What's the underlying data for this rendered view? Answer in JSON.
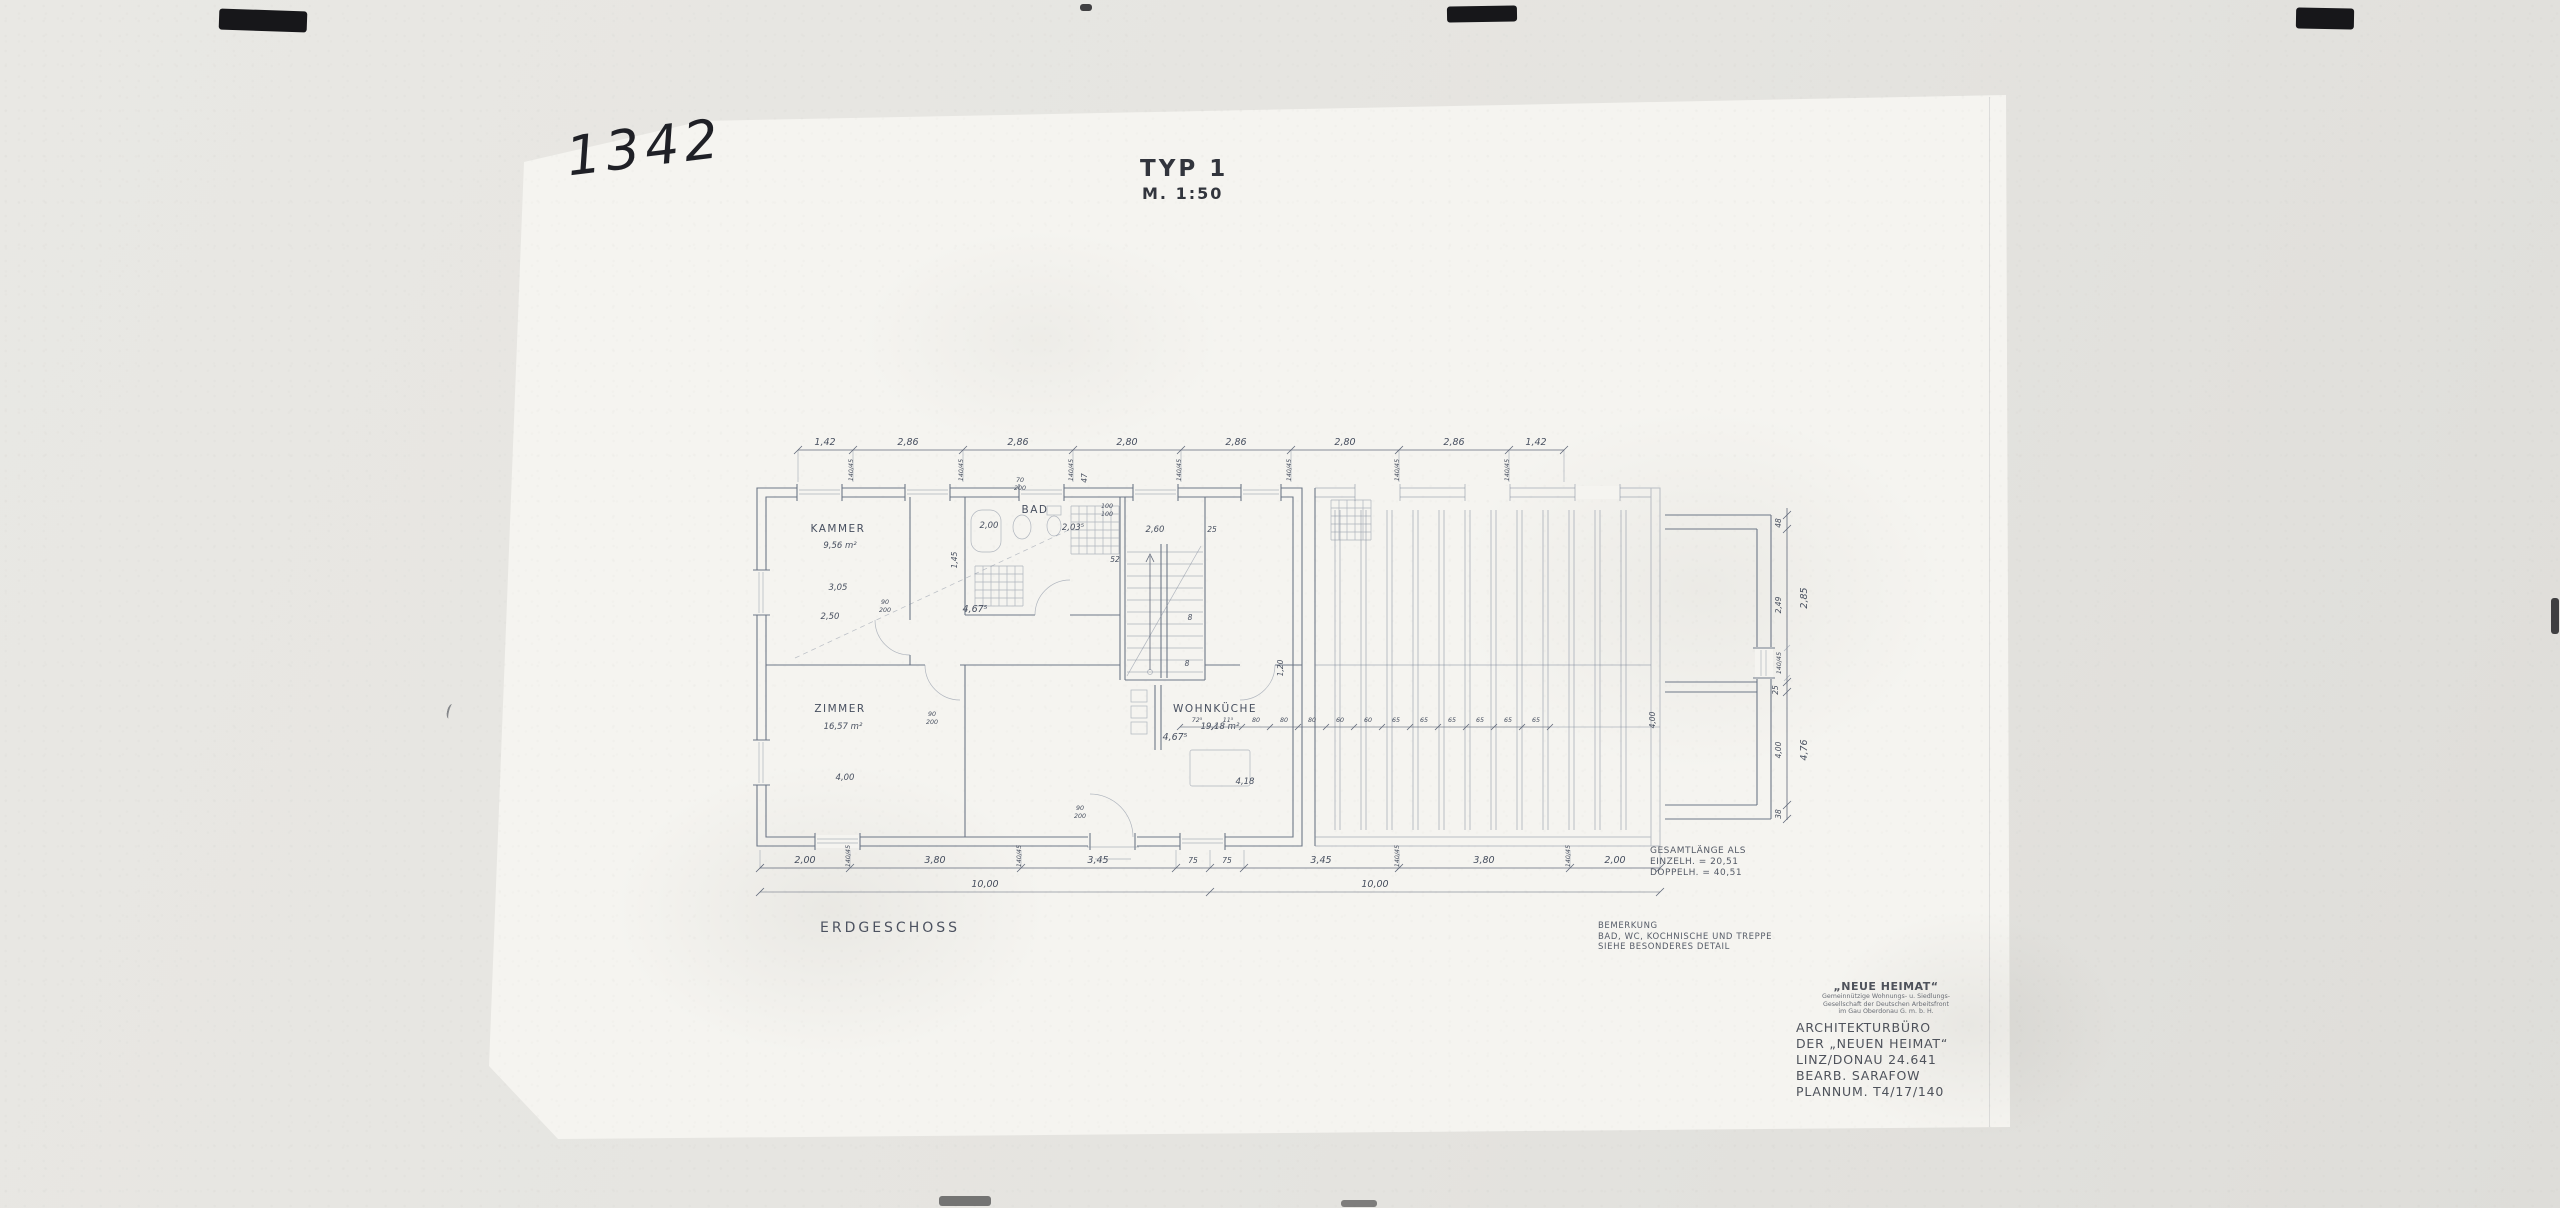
{
  "scan": {
    "handwritten_number": "1342"
  },
  "header": {
    "title": "TYP 1",
    "scale": "M. 1:50"
  },
  "plan": {
    "floor_label": "ERDGESCHOSS",
    "note": {
      "line1": "BEMERKUNG",
      "line2": "BAD, WC, KOCHNISCHE UND TREPPE",
      "line3": "SIEHE BESONDERES DETAIL"
    },
    "total_length": {
      "line1": "GESAMTLÄNGE ALS",
      "line2": "EINZELH. = 20,51",
      "line3": "DOPPELH. = 40,51"
    },
    "rooms": {
      "kammer": {
        "name": "KAMMER",
        "area": "9,56 m²"
      },
      "zimmer": {
        "name": "ZIMMER",
        "area": "16,57 m²"
      },
      "wohnkueche": {
        "name": "WOHNKÜCHE",
        "area": "19,18 m²"
      },
      "bad": {
        "name": "BAD"
      }
    },
    "dims_top": [
      "1,42",
      "2,86",
      "2,86",
      "2,80",
      "2,86",
      "2,80",
      "2,86",
      "1,42"
    ],
    "dims_bottom": [
      "2,00",
      "3,80",
      "3,45",
      "75",
      "75",
      "3,45",
      "3,80",
      "2,00"
    ],
    "totals_bottom": [
      "10,00",
      "10,00"
    ],
    "dims_right": [
      "48",
      "2,49",
      "25",
      "4,00",
      "38"
    ],
    "right_totals": [
      "2,85",
      "4,76"
    ],
    "dims_mid": [
      "72⁵",
      "11⁵",
      "80",
      "80",
      "80",
      "60",
      "60",
      "65",
      "65",
      "65",
      "65",
      "65",
      "65"
    ],
    "window_dim": "140/45",
    "door_dim": {
      "w": "90",
      "h": "200"
    },
    "door_small": {
      "w": "70",
      "h": "200"
    },
    "window_sq": {
      "w": "100",
      "h": "100"
    },
    "misc": {
      "d305": "3,05",
      "d250": "2,50",
      "d200": "2,00",
      "d145": "1,45",
      "d2035": "2,03⁵",
      "d4675": "4,67⁵",
      "d260": "2,60",
      "d25": "25",
      "d52": "52",
      "d400": "4,00",
      "d418": "4,18",
      "d120": "1,20",
      "d8": "8",
      "d47": "47"
    }
  },
  "title_block": {
    "company": "„NEUE HEIMAT“",
    "sub1": "Gemeinnützige Wohnungs- u. Siedlungs-",
    "sub2": "Gesellschaft der Deutschen Arbeitsfront",
    "sub3": "im Gau Oberdonau G. m. b. H.",
    "line1": "ARCHITEKTURBÜRO",
    "line2": "DER „NEUEN HEIMAT“",
    "line3": "LINZ/DONAU 24.641",
    "line4": "BEARB. SARAFOW",
    "line5": "PLANNUM. T4/17/140"
  }
}
